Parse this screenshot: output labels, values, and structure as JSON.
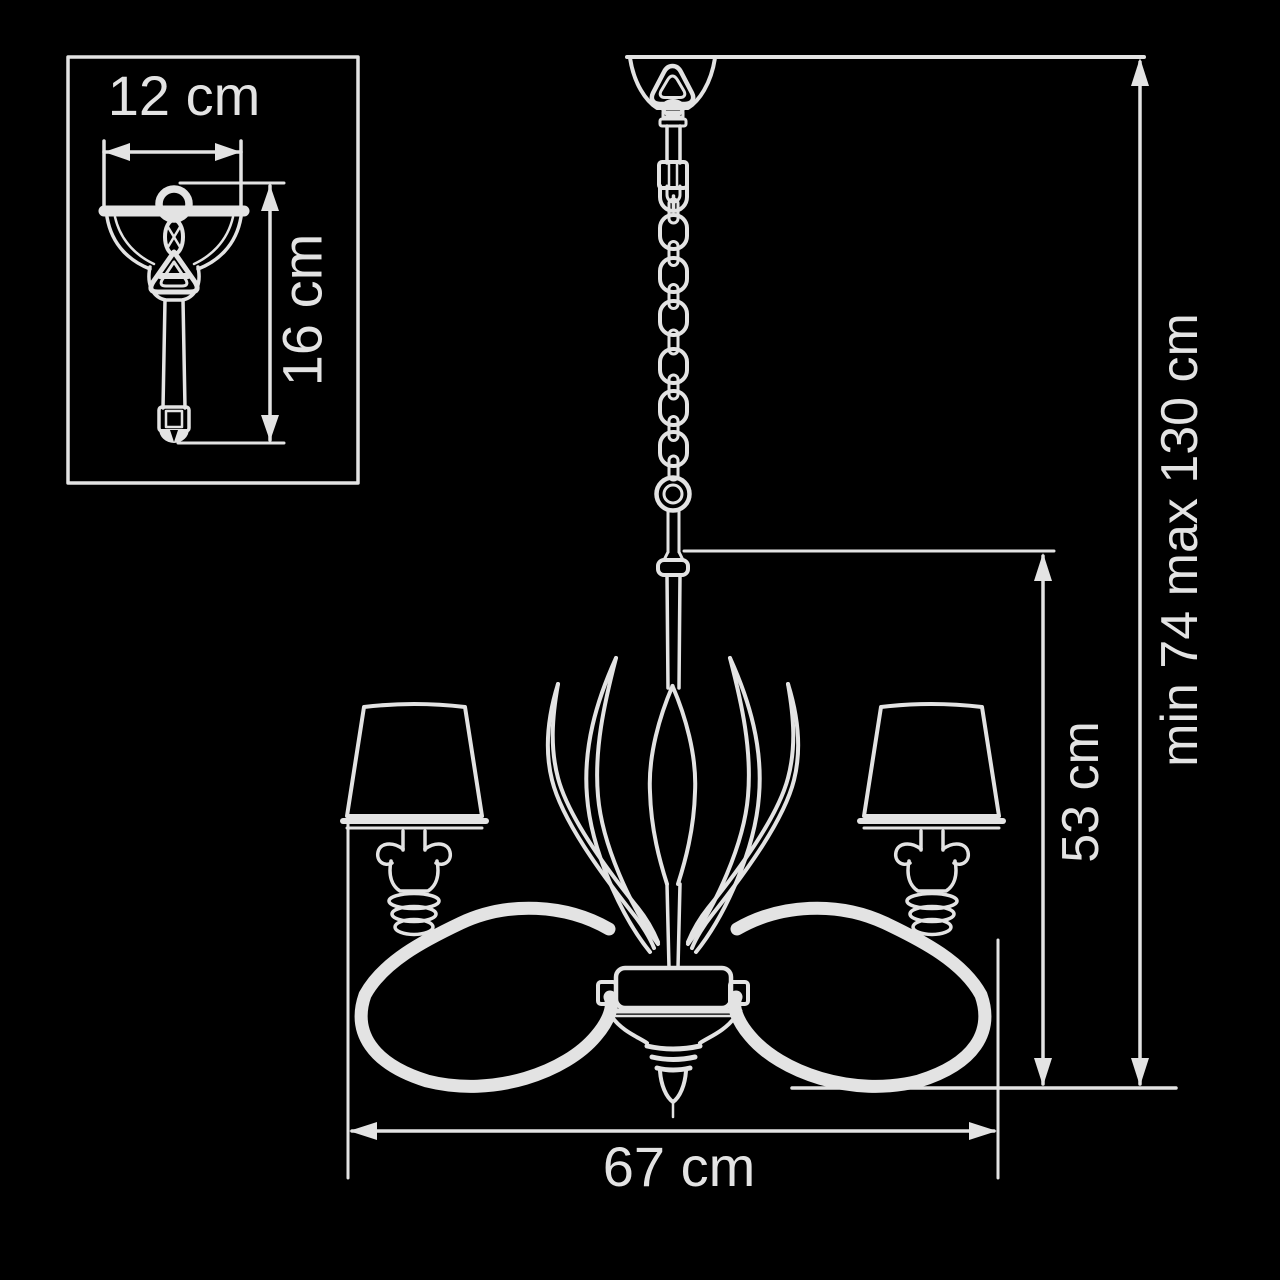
{
  "page": {
    "background": "#000000",
    "line_color": "#e3e3e3",
    "description": "Chandelier technical dimension diagram, white line art on black"
  },
  "inset": {
    "width_label": "12 cm",
    "height_label": "16 cm"
  },
  "main": {
    "width_label": "67 cm",
    "body_height_label": "53 cm",
    "overall_height_label": "min 74 max 130 cm"
  }
}
